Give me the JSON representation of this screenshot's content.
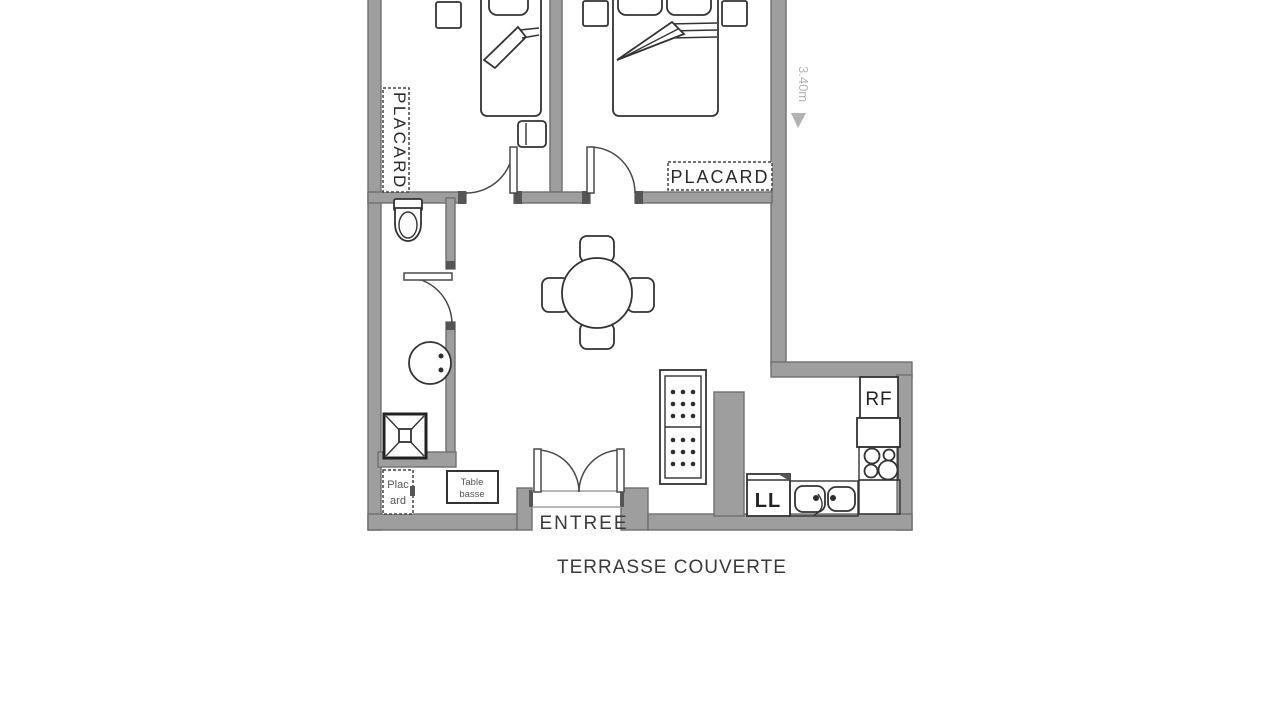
{
  "plan": {
    "type": "apartment-floor-plan",
    "bedroom1": {
      "closet_label": "PLACARD"
    },
    "bedroom2": {
      "closet_label": "PLACARD",
      "dimension_label": "3.40m"
    },
    "hall": {
      "closet_label_line1": "Plac",
      "closet_label_line2": "ard"
    },
    "living": {
      "coffee_table_line1": "Table",
      "coffee_table_line2": "basse"
    },
    "kitchen": {
      "washing_machine_label": "LL",
      "fridge_label": "RF"
    },
    "entrance_label": "ENTREE",
    "terrace_label": "TERRASSE COUVERTE"
  },
  "colors": {
    "background": "#ffffff",
    "wall_fill": "#9e9e9e",
    "wall_outline": "#6f6f6f",
    "wall_end_cap": "#555555",
    "furniture_line": "#333333",
    "label_text": "#2a2a2a",
    "big_label_text": "#3a3a3a",
    "dimension_text": "#b2b2b2"
  }
}
